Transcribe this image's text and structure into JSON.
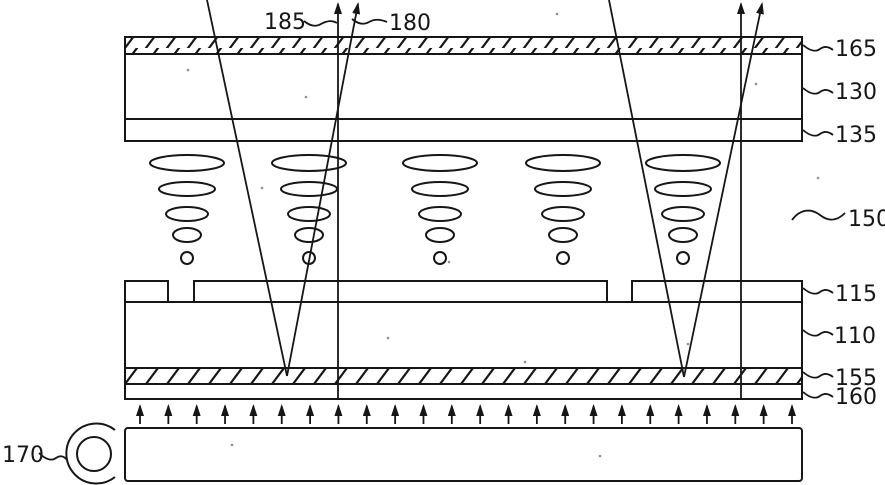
{
  "labels": {
    "l185": "185",
    "l180": "180",
    "l165": "165",
    "l130": "130",
    "l135": "135",
    "l150": "150",
    "l115": "115",
    "l110": "110",
    "l155": "155",
    "l160": "160",
    "l170": "170"
  },
  "diagram": {
    "lens_groups": {
      "centers_x": [
        187,
        309,
        440,
        563,
        683
      ],
      "ellipses": [
        {
          "cy": 163,
          "rx": 37,
          "ry": 8
        },
        {
          "cy": 189,
          "rx": 28,
          "ry": 7
        },
        {
          "cy": 214,
          "rx": 21,
          "ry": 7
        },
        {
          "cy": 235,
          "rx": 14,
          "ry": 7
        }
      ],
      "dot": {
        "cy": 258,
        "r": 6
      }
    },
    "electrode_segments": [
      {
        "x1": 125,
        "x2": 168
      },
      {
        "x1": 194,
        "x2": 607
      },
      {
        "x1": 632,
        "x2": 802
      }
    ],
    "backlight_arrows": {
      "count": 24,
      "x_start": 140,
      "x_end": 792,
      "y_tail": 424,
      "y_head": 406
    },
    "noise_dots": [
      [
        557,
        14
      ],
      [
        188,
        70
      ],
      [
        306,
        97
      ],
      [
        756,
        84
      ],
      [
        818,
        178
      ],
      [
        262,
        188
      ],
      [
        449,
        262
      ],
      [
        525,
        362
      ],
      [
        688,
        344
      ],
      [
        232,
        445
      ],
      [
        600,
        456
      ],
      [
        388,
        338
      ]
    ]
  }
}
